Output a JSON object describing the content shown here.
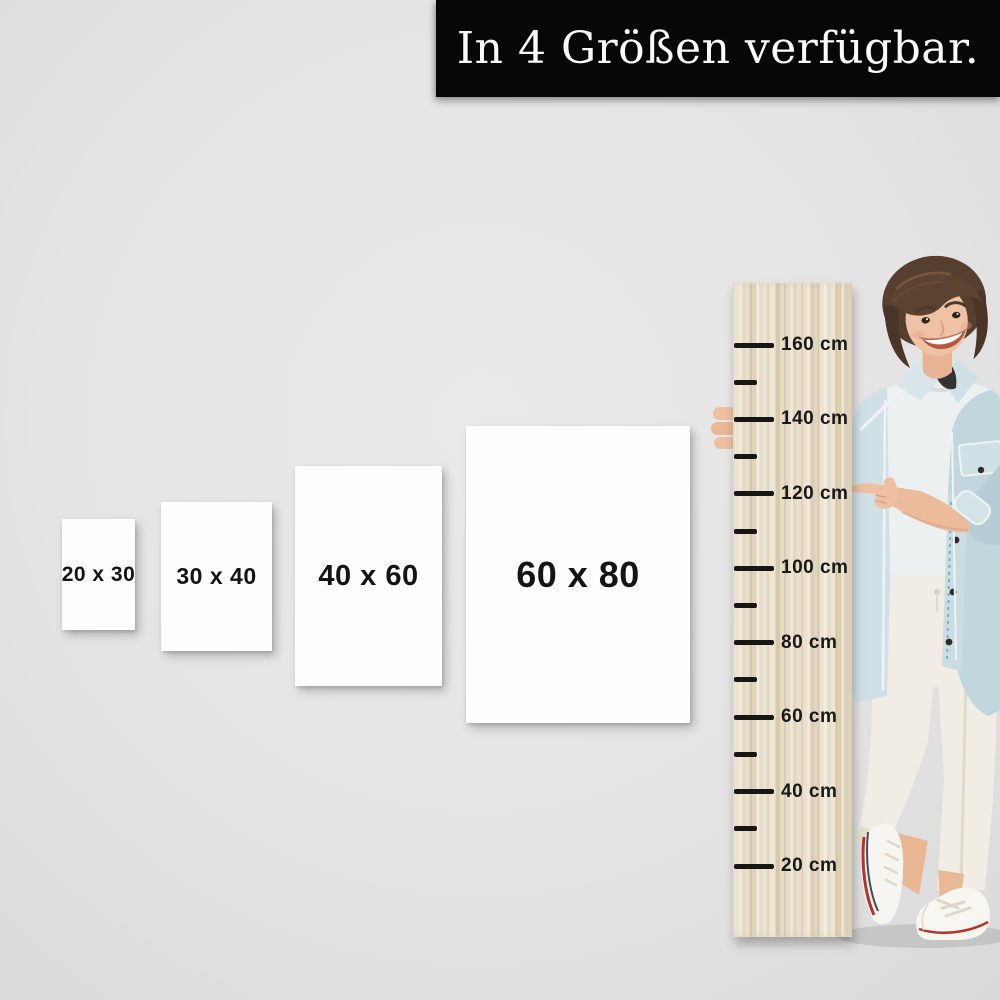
{
  "banner": {
    "title": "In 4 Größen verfügbar.",
    "bg_color": "#070707",
    "text_color": "#fafafa"
  },
  "sizes": [
    {
      "label": "20 x 30"
    },
    {
      "label": "30 x 40"
    },
    {
      "label": "40 x 60"
    },
    {
      "label": "60 x 80"
    }
  ],
  "ruler": {
    "unit": "cm",
    "labels": [
      "160 cm",
      "140 cm",
      "120 cm",
      "100 cm",
      "80 cm",
      "60 cm",
      "40 cm",
      "20 cm"
    ],
    "pointed_mark": "120 cm"
  },
  "model": {
    "alt": "Smiling woman with short brown hair in light denim jacket, white shirt, white trousers and white sneakers, standing beside wooden height ruler and pointing at the 120 cm mark"
  },
  "colors": {
    "background": "#e4e4e4",
    "banner_bg": "#070707",
    "poster_bg": "#fefefe",
    "wood_light": "#ece5d3",
    "wood_dark": "#dcceb2",
    "tick": "#161616",
    "denim": "#cfe0e6",
    "skin": "#ecbb9c",
    "hair": "#563f2e",
    "shoe_red": "#b5342a"
  }
}
